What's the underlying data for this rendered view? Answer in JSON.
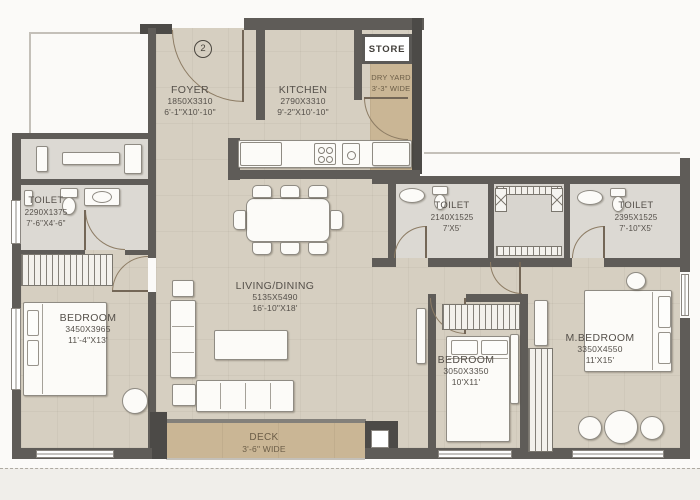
{
  "entry_label": "2",
  "rooms": {
    "foyer": {
      "name": "FOYER",
      "dim_mm": "1850X3310",
      "dim_ft": "6'-1\"X10'-10\""
    },
    "kitchen": {
      "name": "KITCHEN",
      "dim_mm": "2790X3310",
      "dim_ft": "9'-2\"X10'-10\""
    },
    "store": {
      "name": "STORE"
    },
    "dry_yard": {
      "name": "DRY YARD",
      "width_note": "3'-3\" WIDE"
    },
    "toilet_left": {
      "name": "TOILET",
      "dim_mm": "2290X1375",
      "dim_ft": "7'-6\"X4'-6\""
    },
    "toilet_mid": {
      "name": "TOILET",
      "dim_mm": "2140X1525",
      "dim_ft": "7'X5'"
    },
    "toilet_master": {
      "name": "TOILET",
      "dim_mm": "2395X1525",
      "dim_ft": "7'-10\"X5'"
    },
    "living_dining": {
      "name": "LIVING/DINING",
      "dim_mm": "5135X5490",
      "dim_ft": "16'-10\"X18'"
    },
    "bedroom_left": {
      "name": "BEDROOM",
      "dim_mm": "3450X3965",
      "dim_ft": "11'-4\"X13'"
    },
    "bedroom_mid": {
      "name": "BEDROOM",
      "dim_mm": "3050X3350",
      "dim_ft": "10'X11'"
    },
    "master_bedroom": {
      "name": "M.BEDROOM",
      "dim_mm": "3350X4550",
      "dim_ft": "11'X15'"
    },
    "deck": {
      "name": "DECK",
      "width_note": "3'-6\" WIDE"
    }
  },
  "colors": {
    "floor": "#d6cfc1",
    "deck": "#cab695",
    "wall": "#5f5c58",
    "text": "#55504a",
    "outside": "#fbfaf8"
  }
}
